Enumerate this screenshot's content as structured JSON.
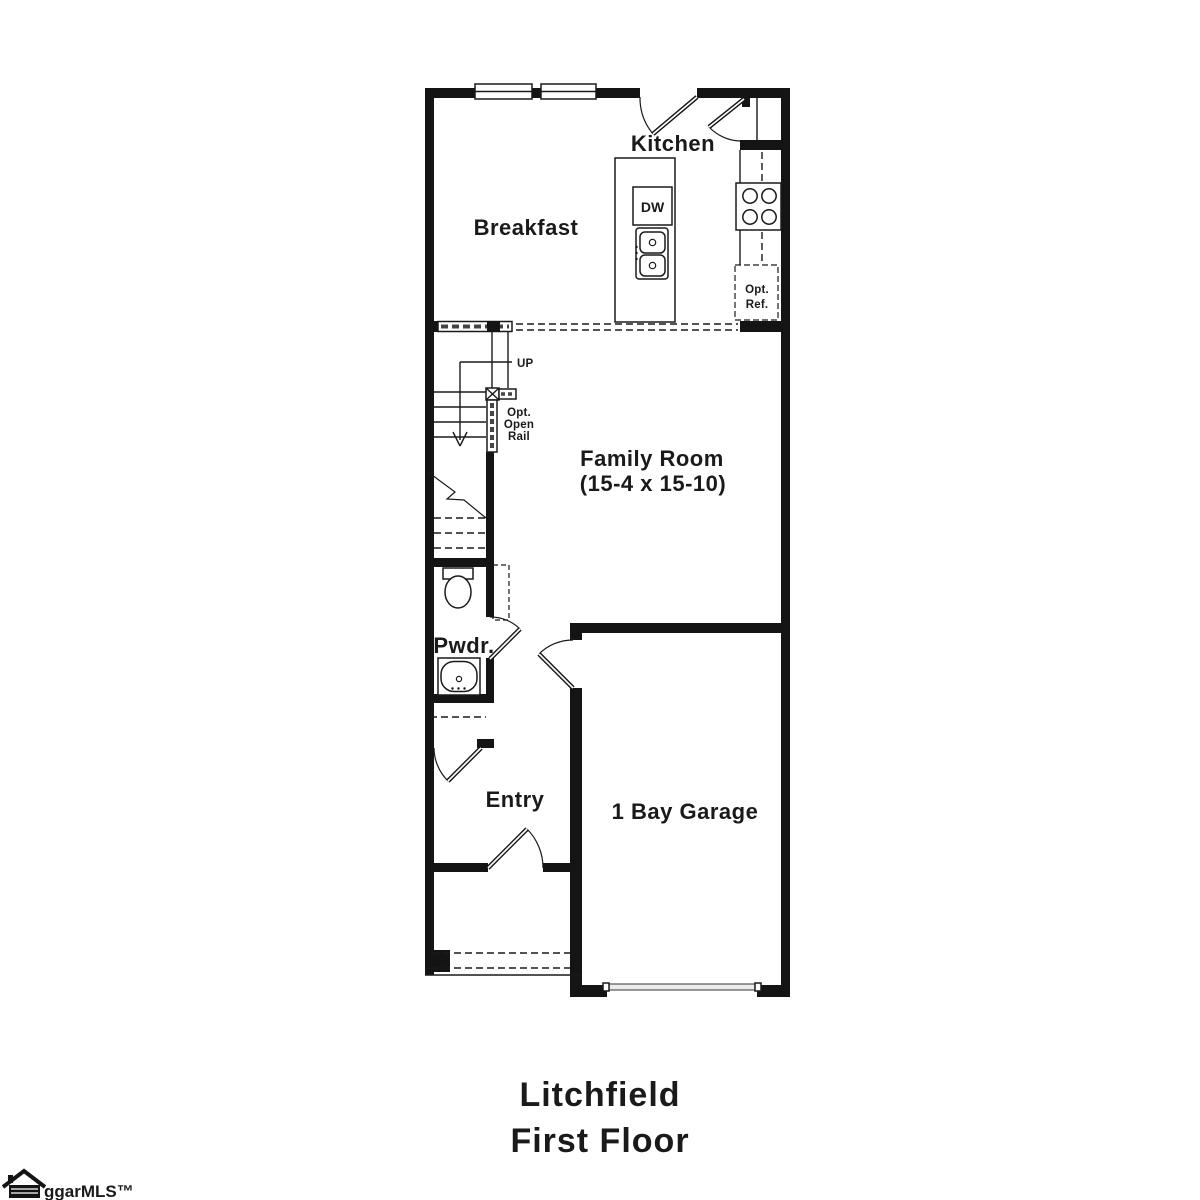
{
  "colors": {
    "ink": "#1a1a1a",
    "background": "#ffffff"
  },
  "floorplan": {
    "rooms": {
      "kitchen": "Kitchen",
      "breakfast": "Breakfast",
      "family_room_name": "Family Room",
      "family_room_dims": "(15-4 x 15-10)",
      "powder": "Pwdr.",
      "entry": "Entry",
      "garage": "1 Bay Garage"
    },
    "labels": {
      "dishwasher": "DW",
      "opt_ref_line1": "Opt.",
      "opt_ref_line2": "Ref.",
      "stairs_up": "UP",
      "open_rail_line1": "Opt.",
      "open_rail_line2": "Open",
      "open_rail_line3": "Rail"
    }
  },
  "title": {
    "line1": "Litchfield",
    "line2": "First Floor"
  },
  "logo": {
    "text": "ggarMLS™",
    "icon": "house-icon"
  }
}
